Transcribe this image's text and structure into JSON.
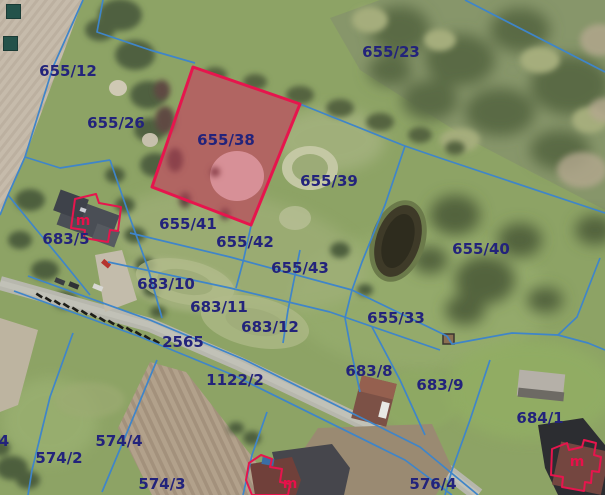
{
  "map": {
    "title": "Cadastral parcel map over aerial imagery",
    "colors": {
      "boundary_line": "#3f85c9",
      "parcel_label": "#23237b",
      "highlight_stroke": "#e6154d",
      "highlight_fill": "rgba(214,55,90,0.38)"
    },
    "highlighted_parcel": {
      "id": "655/38",
      "polygon": "193,67 300,104 251,225 152,187"
    },
    "parcel_labels": [
      {
        "id": "655/12",
        "x": 68,
        "y": 71
      },
      {
        "id": "655/26",
        "x": 116,
        "y": 123
      },
      {
        "id": "655/23",
        "x": 391,
        "y": 52
      },
      {
        "id": "655/38",
        "x": 226,
        "y": 140
      },
      {
        "id": "655/39",
        "x": 329,
        "y": 181
      },
      {
        "id": "655/40",
        "x": 481,
        "y": 249
      },
      {
        "id": "655/41",
        "x": 188,
        "y": 224
      },
      {
        "id": "655/42",
        "x": 245,
        "y": 242
      },
      {
        "id": "655/43",
        "x": 300,
        "y": 268
      },
      {
        "id": "655/33",
        "x": 396,
        "y": 318
      },
      {
        "id": "683/5",
        "x": 66,
        "y": 239
      },
      {
        "id": "683/10",
        "x": 166,
        "y": 284
      },
      {
        "id": "683/11",
        "x": 219,
        "y": 307
      },
      {
        "id": "683/12",
        "x": 270,
        "y": 327
      },
      {
        "id": "2565",
        "x": 183,
        "y": 342
      },
      {
        "id": "1122/2",
        "x": 235,
        "y": 380
      },
      {
        "id": "683/8",
        "x": 369,
        "y": 371
      },
      {
        "id": "683/9",
        "x": 440,
        "y": 385
      },
      {
        "id": "684/1",
        "x": 540,
        "y": 418
      },
      {
        "id": "574/4",
        "x": 119,
        "y": 441
      },
      {
        "id": "574/2",
        "x": 59,
        "y": 458
      },
      {
        "id": "574/3",
        "x": 162,
        "y": 484
      },
      {
        "id": "576/4",
        "x": 433,
        "y": 484
      },
      {
        "id": "4",
        "x": 4,
        "y": 441
      }
    ],
    "building_marks": [
      {
        "label": "m",
        "x": 83,
        "y": 221
      },
      {
        "label": "m",
        "x": 290,
        "y": 484
      },
      {
        "label": "m",
        "x": 577,
        "y": 462
      }
    ],
    "boundaries": [
      "83,0 53,67 25,157 8,195 0,215",
      "103,0 97,32 150,50 195,63",
      "465,0 605,72",
      "300,104 405,146 440,158 605,213",
      "405,146 385,205 362,262 352,290 345,318",
      "130,233 230,257 352,290",
      "108,262 230,288 330,312",
      "330,312 440,350",
      "352,290 447,336",
      "447,336 452,344 512,333 558,335",
      "558,335 577,317 600,258",
      "558,335 588,343 605,350",
      "251,226 243,262 236,288",
      "300,250 288,310 283,343",
      "110,160 130,218 148,268 162,318",
      "25,157 60,168 110,160",
      "8,195 35,228 60,258 90,295",
      "28,276 150,320 245,360 420,447 478,495",
      "14,291 138,336 233,375 405,460 452,495",
      "73,333 50,397 32,470 28,495",
      "157,360 128,430 102,492",
      "267,412 252,455 243,495",
      "490,360 470,420 452,470 445,495",
      "345,318 352,355 360,392",
      "372,327 400,380 425,435"
    ]
  }
}
